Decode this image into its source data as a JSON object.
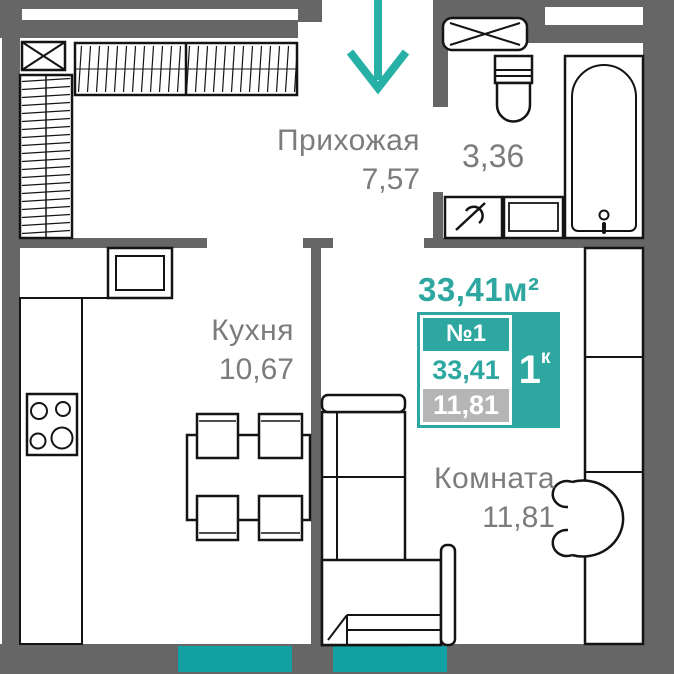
{
  "colors": {
    "wall": "#666666",
    "accent": "#2FA7A1",
    "arrow": "#27B1A6",
    "window_glass": "#12A0A2",
    "label": "#7C7C7C",
    "row_gray": "#B5B5B5"
  },
  "rooms": {
    "hallway": {
      "name": "Прихожая",
      "area": "7,57"
    },
    "kitchen": {
      "name": "Кухня",
      "area": "10,67"
    },
    "living": {
      "name": "Комната",
      "area": "11,81"
    },
    "bathroom": {
      "area": "3,36"
    }
  },
  "card": {
    "total_area_title": "33,41м²",
    "number": "№1",
    "rooms_count": "1",
    "rooms_unit": "к",
    "area_total": "33,41",
    "area_living": "11,81"
  }
}
